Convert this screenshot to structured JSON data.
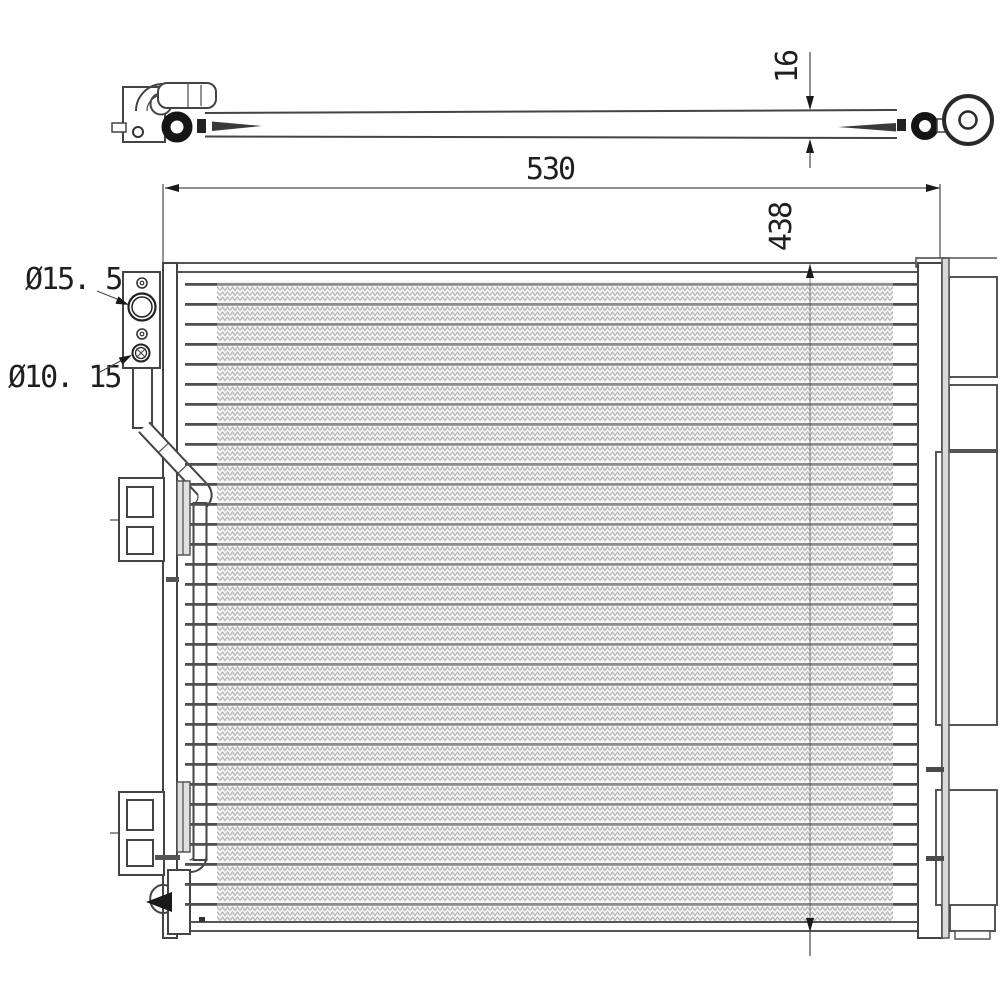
{
  "drawing": {
    "type": "technical-drawing",
    "subject": "ac-condenser",
    "dimensions": {
      "core_width": "530",
      "core_height": "438",
      "pipe_diameter": "16",
      "port_large_label": "Ø15. 5",
      "port_small_label": "Ø10. 15"
    },
    "colors": {
      "background": "#ffffff",
      "outline": "#444444",
      "dark_ink": "#1a1a1a",
      "tube_line": "#8d8d8d",
      "fin_texture": "#b4b4b4",
      "drier_bar": "#d9d9d9"
    }
  }
}
